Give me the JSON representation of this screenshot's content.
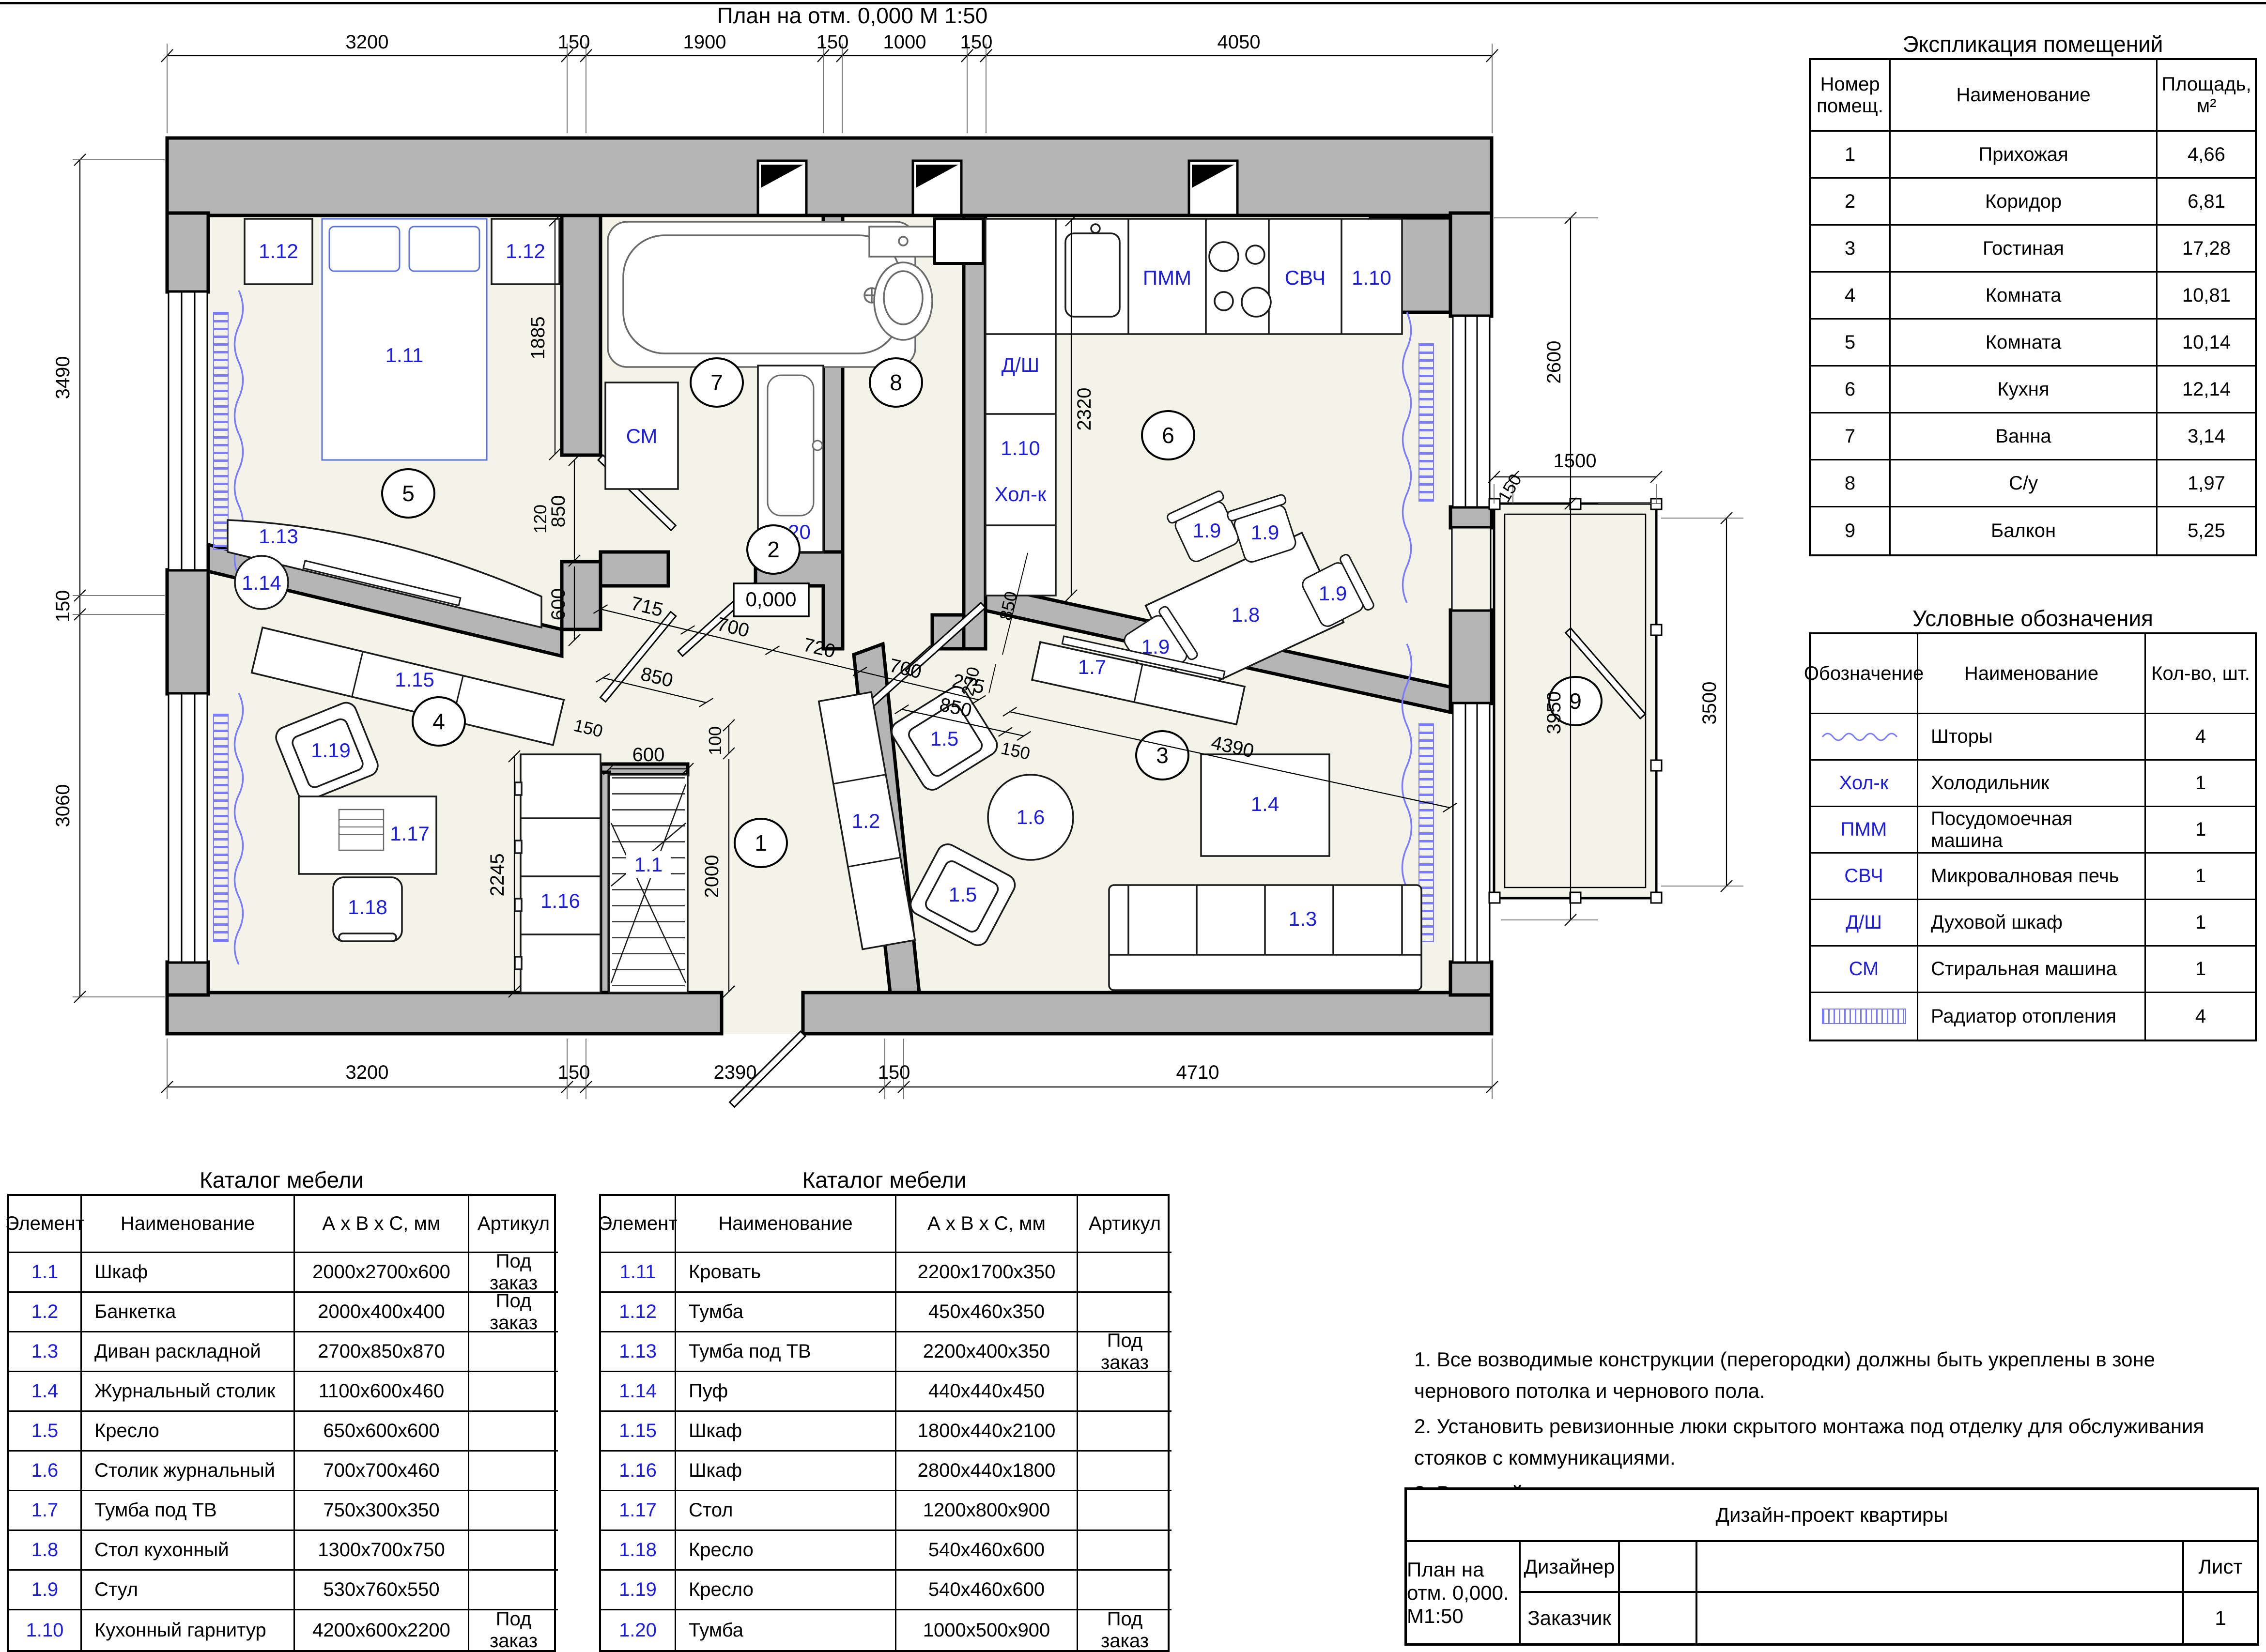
{
  "page": {
    "title": "План на отм. 0,000   М 1:50"
  },
  "plan": {
    "level_mark": "0,000",
    "rooms": [
      "1",
      "2",
      "3",
      "4",
      "5",
      "6",
      "7",
      "8",
      "9"
    ],
    "labels": {
      "closet": "1.1",
      "bench": "1.2",
      "sofa": "1.3",
      "coffee_table": "1.4",
      "armchair": "1.5",
      "round_table": "1.6",
      "tv_living": "1.7",
      "dining_table": "1.8",
      "chair": "1.9",
      "kitchen_set": "1.10",
      "bed": "1.11",
      "nightstand": "1.12",
      "tv_bedroom": "1.13",
      "pouf": "1.14",
      "wardrobe_5": "1.15",
      "wardrobe_4": "1.16",
      "desk": "1.17",
      "desk_chair": "1.18",
      "armchair_4": "1.19",
      "bath_cabinet": "1.20"
    },
    "appliances": {
      "washer": "СМ",
      "dishwasher": "ПММ",
      "microwave": "СВЧ",
      "oven": "Д/Ш",
      "fridge": "Хол-к"
    },
    "dims": {
      "top": [
        "3200",
        "150",
        "1900",
        "150",
        "1000",
        "150",
        "4050"
      ],
      "bottom": [
        "3200",
        "150",
        "2390",
        "150",
        "4710"
      ],
      "left": [
        "3490",
        "150",
        "3060"
      ],
      "rightcol": [
        "2600",
        "3950"
      ],
      "balcony": [
        "1500",
        "150",
        "3500"
      ],
      "bedroom": [
        "1885",
        "120",
        "850",
        "600"
      ],
      "corridor": [
        "715",
        "700",
        "720",
        "700",
        "275"
      ],
      "room4": [
        "850",
        "150"
      ],
      "hall": [
        "100",
        "2000",
        "600",
        "2245"
      ],
      "living": [
        "4390",
        "850",
        "150"
      ],
      "kitchen": [
        "2320",
        "230",
        "850"
      ]
    }
  },
  "explication": {
    "title": "Экспликация помещений",
    "headers": [
      "Номер помещ.",
      "Наименование",
      "Площадь, м²"
    ],
    "rows": [
      [
        "1",
        "Прихожая",
        "4,66"
      ],
      [
        "2",
        "Коридор",
        "6,81"
      ],
      [
        "3",
        "Гостиная",
        "17,28"
      ],
      [
        "4",
        "Комната",
        "10,81"
      ],
      [
        "5",
        "Комната",
        "10,14"
      ],
      [
        "6",
        "Кухня",
        "12,14"
      ],
      [
        "7",
        "Ванна",
        "3,14"
      ],
      [
        "8",
        "С/у",
        "1,97"
      ],
      [
        "9",
        "Балкон",
        "5,25"
      ]
    ]
  },
  "legend": {
    "title": "Условные обозначения",
    "headers": [
      "Обозначение",
      "Наименование",
      "Кол-во, шт."
    ],
    "rows": [
      {
        "symbol_kind": "curtain-icon",
        "symbol_text": "",
        "name": "Шторы",
        "qty": "4"
      },
      {
        "symbol_kind": "text",
        "symbol_text": "Хол-к",
        "name": "Холодильник",
        "qty": "1"
      },
      {
        "symbol_kind": "text",
        "symbol_text": "ПММ",
        "name": "Посудомоечная машина",
        "qty": "1"
      },
      {
        "symbol_kind": "text",
        "symbol_text": "СВЧ",
        "name": "Микровалновая печь",
        "qty": "1"
      },
      {
        "symbol_kind": "text",
        "symbol_text": "Д/Ш",
        "name": "Духовой шкаф",
        "qty": "1"
      },
      {
        "symbol_kind": "text",
        "symbol_text": "СМ",
        "name": "Стиральная машина",
        "qty": "1"
      },
      {
        "symbol_kind": "radiator-icon",
        "symbol_text": "",
        "name": "Радиатор отопления",
        "qty": "4"
      }
    ]
  },
  "catalog1": {
    "title": "Каталог мебели",
    "headers": [
      "Элемент",
      "Наименование",
      "А х В х С, мм",
      "Артикул"
    ],
    "rows": [
      [
        "1.1",
        "Шкаф",
        "2000х2700х600",
        "Под заказ"
      ],
      [
        "1.2",
        "Банкетка",
        "2000х400х400",
        "Под заказ"
      ],
      [
        "1.3",
        "Диван раскладной",
        "2700х850х870",
        ""
      ],
      [
        "1.4",
        "Журнальный столик",
        "1100х600х460",
        ""
      ],
      [
        "1.5",
        "Кресло",
        "650х600х600",
        ""
      ],
      [
        "1.6",
        "Столик журнальный",
        "700х700х460",
        ""
      ],
      [
        "1.7",
        "Тумба под ТВ",
        "750х300х350",
        ""
      ],
      [
        "1.8",
        "Стол кухонный",
        "1300х700х750",
        ""
      ],
      [
        "1.9",
        "Стул",
        "530х760х550",
        ""
      ],
      [
        "1.10",
        "Кухонный гарнитур",
        "4200х600х2200",
        "Под заказ"
      ]
    ]
  },
  "catalog2": {
    "title": "Каталог мебели",
    "headers": [
      "Элемент",
      "Наименование",
      "А х В х С, мм",
      "Артикул"
    ],
    "rows": [
      [
        "1.11",
        "Кровать",
        "2200х1700х350",
        ""
      ],
      [
        "1.12",
        "Тумба",
        "450х460х350",
        ""
      ],
      [
        "1.13",
        "Тумба под ТВ",
        "2200х400х350",
        "Под заказ"
      ],
      [
        "1.14",
        "Пуф",
        "440х440х450",
        ""
      ],
      [
        "1.15",
        "Шкаф",
        "1800х440х2100",
        ""
      ],
      [
        "1.16",
        "Шкаф",
        "2800х440х1800",
        ""
      ],
      [
        "1.17",
        "Стол",
        "1200х800х900",
        ""
      ],
      [
        "1.18",
        "Кресло",
        "540х460х600",
        ""
      ],
      [
        "1.19",
        "Кресло",
        "540х460х600",
        ""
      ],
      [
        "1.20",
        "Тумба",
        "1000х500х900",
        "Под заказ"
      ]
    ]
  },
  "notes": {
    "items": [
      "1. Все возводимые конструкции (перегородки) должны быть укреплены в зоне чернового потолка и чернового пола.",
      "2. Установить ревизионные люки скрытого монтажа под отделку для обслуживания стояков с коммуникациями.",
      "3. В ванной и санузле выполнить гидроизоляцию пола с заходом на стены не менее 300 мм."
    ]
  },
  "titleblock": {
    "project": "Дизайн-проект квартиры",
    "designer_label": "Дизайнер",
    "customer_label": "Заказчик",
    "drawing": "План на отм. 0,000.  М1:50",
    "sheet_label": "Лист",
    "sheet_number": "1"
  }
}
